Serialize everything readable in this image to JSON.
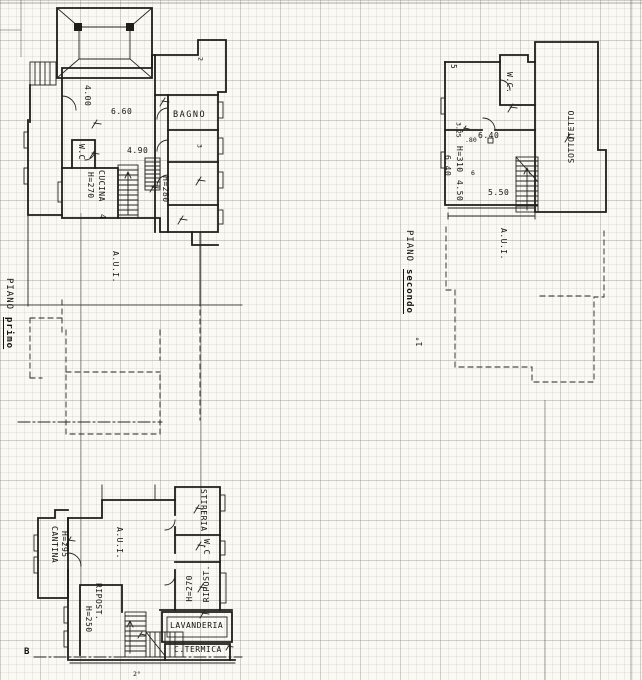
{
  "floor1": {
    "title_word": "PIANO",
    "title_name": "primo",
    "rooms": {
      "bagno": "BAGNO",
      "wc": "W.C",
      "cucina": "CUCINA",
      "aui": "A.U.I."
    },
    "dims": {
      "d400": "4.00",
      "d660": "6.60",
      "d490": "4.90",
      "h270": "H=270",
      "h280": "H=280"
    },
    "numbers": {
      "room2": "2",
      "room3": "3",
      "room4": "4"
    }
  },
  "floor2": {
    "title_word": "PIANO",
    "title_name": "secondo",
    "scale_mark": "1°",
    "rooms": {
      "wc": "W.C.",
      "sottotetto": "SOTTOTETTO",
      "aui": "A.U.I."
    },
    "dims": {
      "d640": "6.40",
      "d640v": "6.40",
      "d550": "5.50",
      "h310": "H=310",
      "d450": "4.50",
      "d080": ".80",
      "d325": "3.25"
    },
    "numbers": {
      "room5": "5",
      "room6": "6"
    }
  },
  "basement": {
    "rooms": {
      "cantina": "CANTINA",
      "aui": "A.U.I.",
      "ripost_left": "RIPOST.",
      "stireria": "STIRERIA",
      "wc": "W.C",
      "ripost_right": "RIPOST.",
      "lavanderia": "LAVANDERIA",
      "ctermica": "C.TERMICA"
    },
    "dims": {
      "h295": "H=295",
      "h250": "H=250",
      "h270": "H=270"
    },
    "marks": {
      "section": "B",
      "bottom": "2°"
    }
  }
}
